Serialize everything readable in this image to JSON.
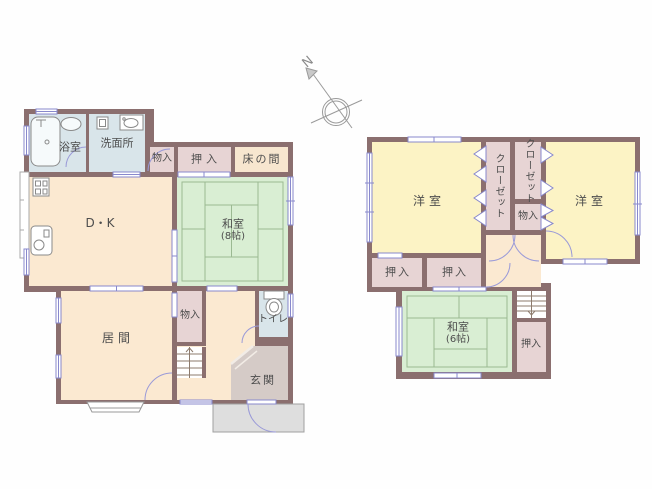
{
  "compass": {
    "north": "N"
  },
  "f1": {
    "bath": "浴室",
    "washroom": "洗面所",
    "storage_top": "物入",
    "oshiire_top": "押入",
    "tokonoma": "床の間",
    "dk": "D・K",
    "washitsu": "和室",
    "washitsu_size": "(8帖)",
    "living": "居間",
    "storage_mid": "物入",
    "toilet": "トイレ",
    "genkan": "玄関"
  },
  "f2": {
    "yoshitsu_left": "洋室",
    "closet_left": "クローゼット",
    "closet_right": "クローゼット",
    "storage": "物入",
    "yoshitsu_right": "洋室",
    "oshiire_left": "押入",
    "oshiire_center": "押入",
    "washitsu": "和室",
    "washitsu_size": "(6帖)",
    "oshiire_side": "押入"
  },
  "colors": {
    "wall": "#8b6f6f",
    "room_peach": "#fbe9d1",
    "tatami_green": "#d9eed3",
    "water_blue": "#d9e5ea",
    "closet_pink": "#e7d4d4",
    "western_yellow": "#fcf3c5",
    "genkan_gray": "#d5cbc7",
    "porch_gray": "#dedede",
    "opening_blue": "#8888cc",
    "label_gray": "#4d4d4d"
  }
}
